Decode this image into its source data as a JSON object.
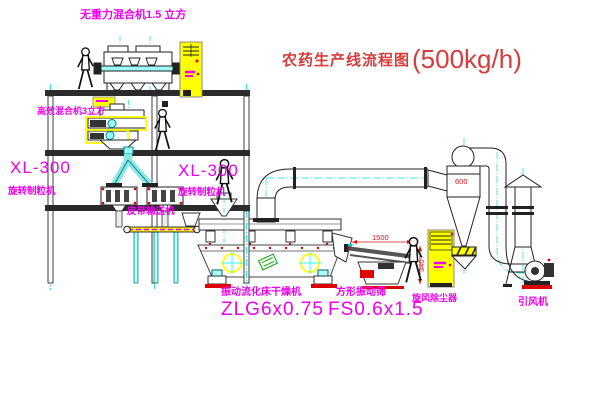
{
  "colors": {
    "label_magenta": "#ee00ee",
    "title_red": "#d83b3b",
    "dimension_red": "#dd1111",
    "cabinet_yellow": "#ffff00",
    "pipe_centerline_cyan": "#00dddd",
    "line_dark": "#222222",
    "nameplate_green": "#00aa00"
  },
  "title": {
    "name": "农药生产线流程图",
    "capacity": "(500kg/h)"
  },
  "equipment": {
    "top_mixer_label": "无重力混合机1.5 立方",
    "mid_mixer_label": "高效混合机3立方",
    "granulator_left": {
      "model": "XL-300",
      "name": "旋转制粒机"
    },
    "granulator_right": {
      "model": "XL-300",
      "name": "旋转制粒机"
    },
    "belt_conveyor_label": "皮带输送机",
    "dryer": {
      "name": "振动流化床干燥机",
      "model": "ZLG6x0.75"
    },
    "screen": {
      "name": "方形振动筛",
      "model": "FS0.6x1.5"
    },
    "cyclone_label": "旋风除尘器",
    "fan_label": "引风机"
  },
  "dimensions": {
    "screen_length": "1500",
    "screen_height": "340",
    "cyclone_size": "600"
  }
}
